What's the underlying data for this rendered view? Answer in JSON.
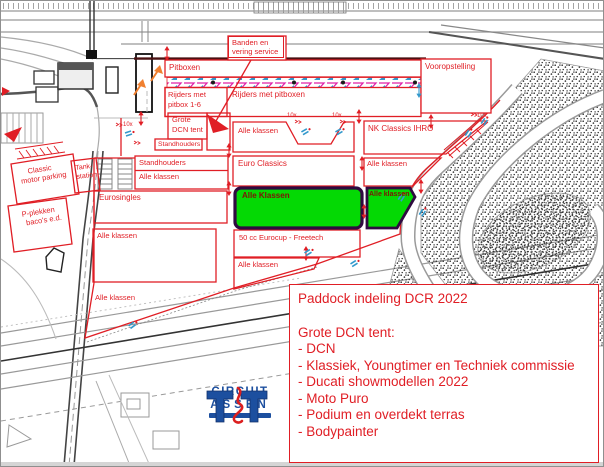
{
  "map": {
    "pitboxen": "Pitboxen",
    "banden_l1": "Banden en",
    "banden_l2": "vering service",
    "rijders16_l1": "Rijders met",
    "rijders16_l2": "pitbox 1-6",
    "rijders_pitboxen": "Rijders met pitboxen",
    "vooropstelling": "Vooropstelling",
    "grote_l1": "Grote",
    "grote_l2": "DCN tent",
    "standhouders_small": "Standhouders",
    "marker_10x": "10x",
    "alle_klassen_top": "Alle klassen",
    "nk_classics": "NK Classics IHRO",
    "standhouders": "Standhouders",
    "alle_klassen_stand": "Alle klassen",
    "euro_classics": "Euro Classics",
    "alle_klassen_right": "Alle klassen",
    "green_main": "Alle Klassen",
    "green_small": "Alle klassen",
    "eurosingles": "Eurosingles",
    "eurocup50": "50 cc Eurocup - Freetech",
    "alle_klassen_left": "Alle klassen",
    "alle_klassen_bottom": "Alle klassen",
    "alle_klassen_diag": "Alle klassen",
    "classic_l1": "Classic",
    "classic_l2": "motor parking",
    "pplekken_l1": "P-plekken",
    "pplekken_l2": "baco's e.d.",
    "tank_l1": "Tank-",
    "tank_l2": "station"
  },
  "legend": {
    "title": "Paddock indeling DCR 2022",
    "subtitle": "Grote DCN tent:",
    "items": [
      "- DCN",
      "- Klassiek, Youngtimer en Techniek commissie",
      "- Ducati showmodellen 2022",
      "- Moto Puro",
      "- Podium en overdekt terras",
      "- Bodypainter"
    ]
  },
  "logo": {
    "line1": "CIRCUIT",
    "line2": "ASSEN"
  },
  "colors": {
    "red": "#e01e25",
    "dark_red_line": "#4a1012",
    "green": "#04d904",
    "green_border": "#2f0a40",
    "logo_blue": "#1c4f9f",
    "magenta": "#e020a8",
    "cyan": "#3399cc",
    "orange": "#f08030"
  }
}
